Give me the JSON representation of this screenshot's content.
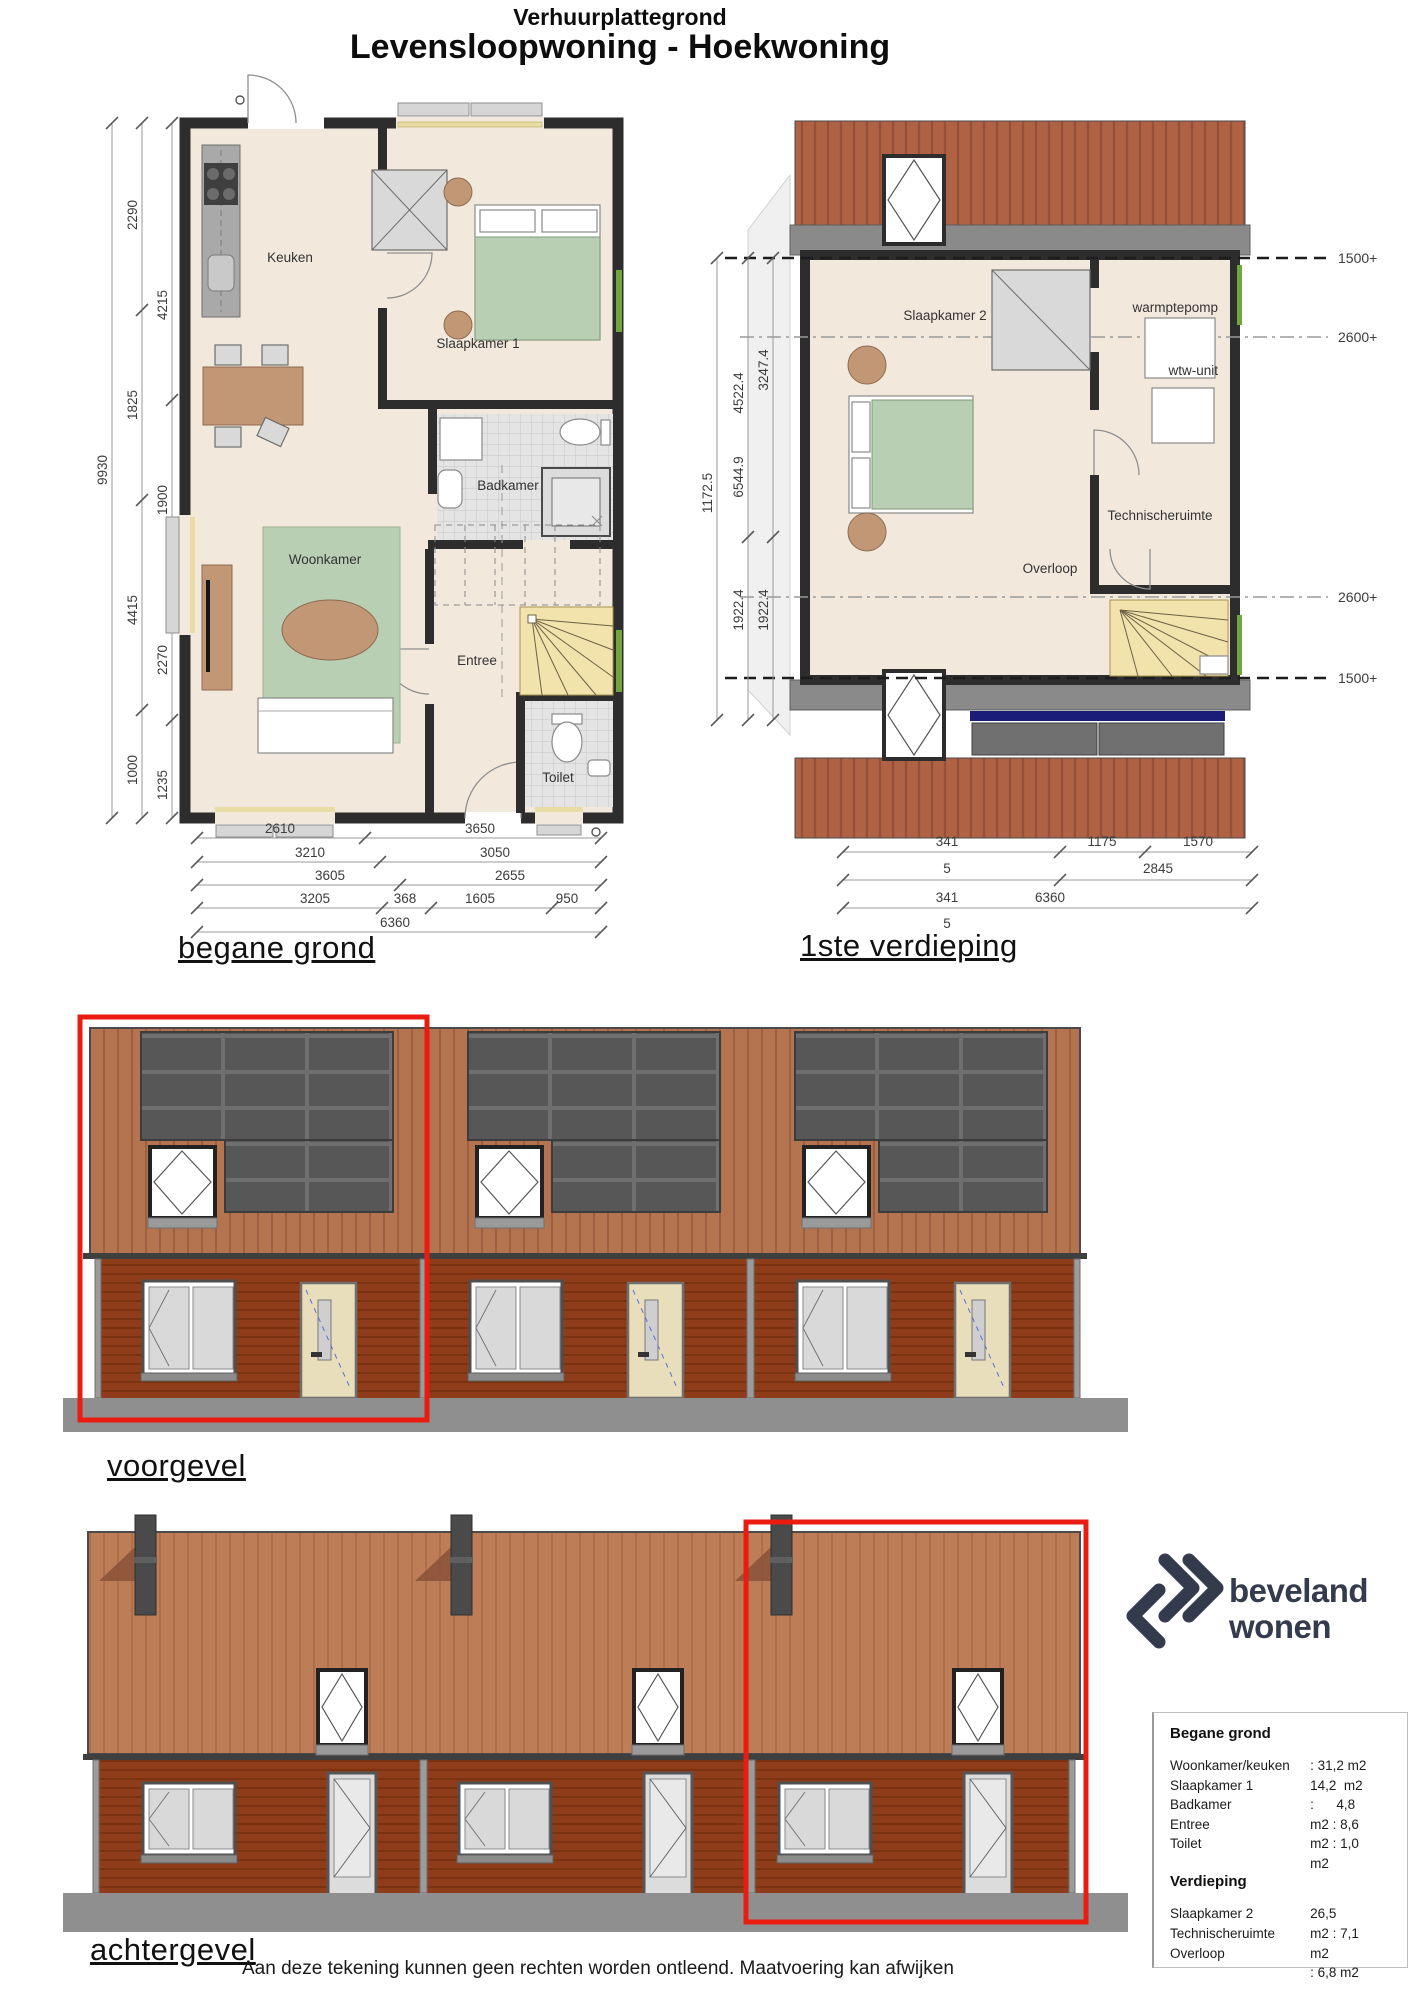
{
  "title": {
    "subtitle": "Verhuurplattegrond",
    "main": "Levensloopwoning - Hoekwoning"
  },
  "ground_floor": {
    "label": "begane grond",
    "rooms": {
      "keuken": "Keuken",
      "slaapkamer1": "Slaapkamer 1",
      "badkamer": "Badkamer",
      "woonkamer": "Woonkamer",
      "entree": "Entree",
      "toilet": "Toilet"
    },
    "dims_left": {
      "total": "9930",
      "outer": [
        "2290",
        "1825",
        "4415",
        "1000"
      ],
      "inner": [
        "4215",
        "1900",
        "2270",
        "1235"
      ]
    },
    "dims_bottom": {
      "row1": [
        "2610",
        "3650"
      ],
      "row2": [
        "3210",
        "3050"
      ],
      "row3": [
        "3605",
        "2655"
      ],
      "row4": [
        "3205",
        "368",
        "1605",
        "950"
      ],
      "row5": [
        "6360"
      ]
    }
  },
  "first_floor": {
    "label": "1ste verdieping",
    "rooms": {
      "slaapkamer2": "Slaapkamer 2",
      "warmtepomp": "warmptepomp",
      "wtw": "wtw-unit",
      "technische": "Technischeruimte",
      "overloop": "Overloop"
    },
    "dims_left": {
      "col1": "1172.5",
      "col2": [
        "4522.4",
        "6544.9",
        "1922.4"
      ],
      "col3": [
        "3247.4",
        "1922.4"
      ]
    },
    "dims_bottom": {
      "row1": [
        "341",
        "1175",
        "1570"
      ],
      "row2": [
        "5",
        "2845"
      ],
      "row3": [
        "341",
        "6360"
      ],
      "row4": [
        "5"
      ]
    },
    "height_labels": [
      "1500+",
      "2600+",
      "2600+",
      "1500+"
    ]
  },
  "front_elevation": {
    "label": "voorgevel"
  },
  "rear_elevation": {
    "label": "achtergevel"
  },
  "logo": {
    "line1": "beveland",
    "line2": "wonen"
  },
  "area_table": {
    "ground": {
      "title": "Begane grond",
      "labels": [
        "Woonkamer/keuken",
        "Slaapkamer 1",
        "Badkamer",
        "Entree",
        "Toilet"
      ],
      "values": [
        ": 31,2 m2",
        "14,2  m2",
        ":      4,8",
        "m2 : 8,6",
        "m2 : 1,0",
        "m2"
      ]
    },
    "floor": {
      "title": "Verdieping",
      "labels": [
        "Slaapkamer 2",
        "Technischeruimte",
        "Overloop"
      ],
      "values": [
        "26,5",
        "m2 : 7,1",
        "m2",
        ": 6,8 m2"
      ]
    }
  },
  "disclaimer": "Aan deze tekening  kunnen geen rechten worden ontleend. Maatvoering kan afwijken"
}
